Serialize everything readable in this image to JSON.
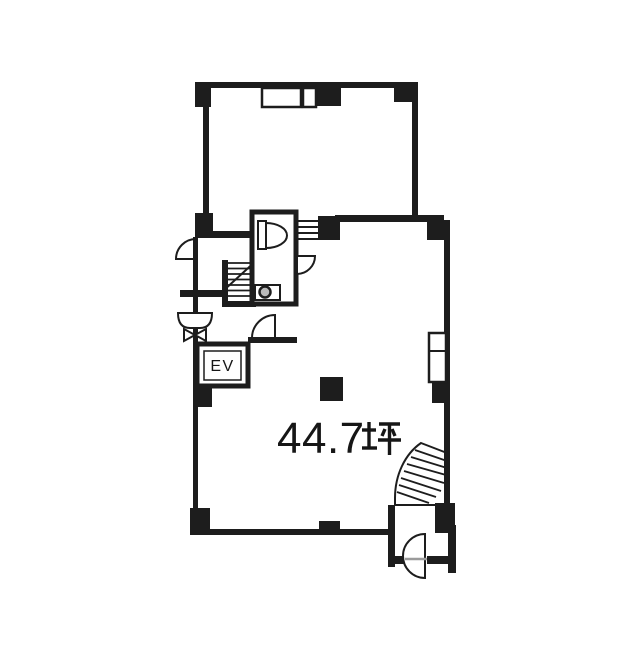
{
  "floorplan": {
    "area_label": "44.7坪",
    "area_value": "44.7",
    "area_unit": "坪",
    "elevator_label": "EV",
    "colors": {
      "wall": "#1d1d1d",
      "background": "#ffffff",
      "text": "#161616",
      "muted_line": "#9b9b9b"
    },
    "symbols": {
      "elevator": "EV cabin box with double outline",
      "toilet": "toilet tank and bowl fixture",
      "utility_sink": "slop sink box with round basin",
      "wash_basin": "basin bowl with pedestal bowtie",
      "straight_stairs": "straight stair flight with break line",
      "winder_stairs": "curved winder stair flight",
      "door_swing": "quarter and half circle door arcs",
      "pipe_space": "duct shaft box on right wall",
      "window": "four-line window hatch",
      "column": "solid black structural column"
    }
  }
}
